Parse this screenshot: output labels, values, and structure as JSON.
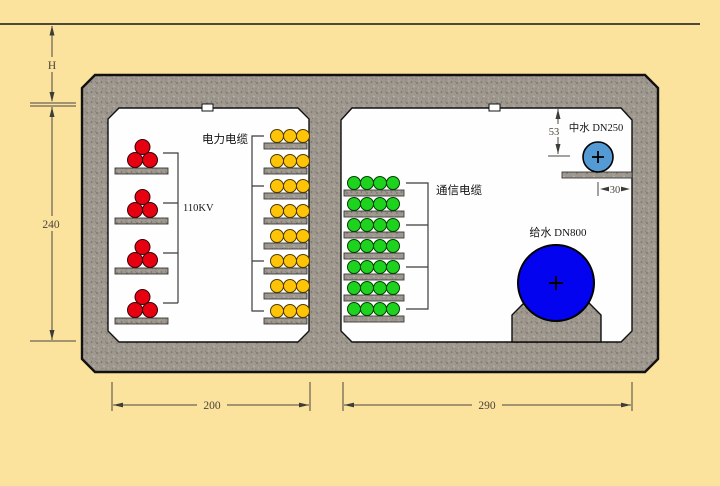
{
  "diagram": {
    "type": "utility-tunnel-cross-section",
    "ground_depth_label": "H",
    "interior_height": "240",
    "left_chamber_width": "200",
    "right_chamber_width": "290",
    "labels": {
      "power_cable": "电力电缆",
      "hv_rating": "110KV",
      "comm_cable": "通信电缆",
      "reclaimed_water": "中水 DN250",
      "water_supply": "给水 DN800",
      "ceiling_clearance": "53",
      "wall_clearance": "30"
    },
    "racks": {
      "hv": {
        "levels": 4,
        "cables_per_level": 3,
        "arrangement": "trefoil"
      },
      "power": {
        "levels": 8,
        "cables_per_level": 3
      },
      "comm": {
        "levels": 7,
        "cables_per_level": 4
      }
    },
    "colors": {
      "background": "#FBE29D",
      "concrete": "#9D978E",
      "chamber": "#FEFEFE",
      "hv_cable": "#E60010",
      "power_cable": "#FFC408",
      "comm_cable": "#1ED31E",
      "reclaimed_pipe": "#549BD5",
      "supply_pipe": "#0303EF"
    }
  }
}
